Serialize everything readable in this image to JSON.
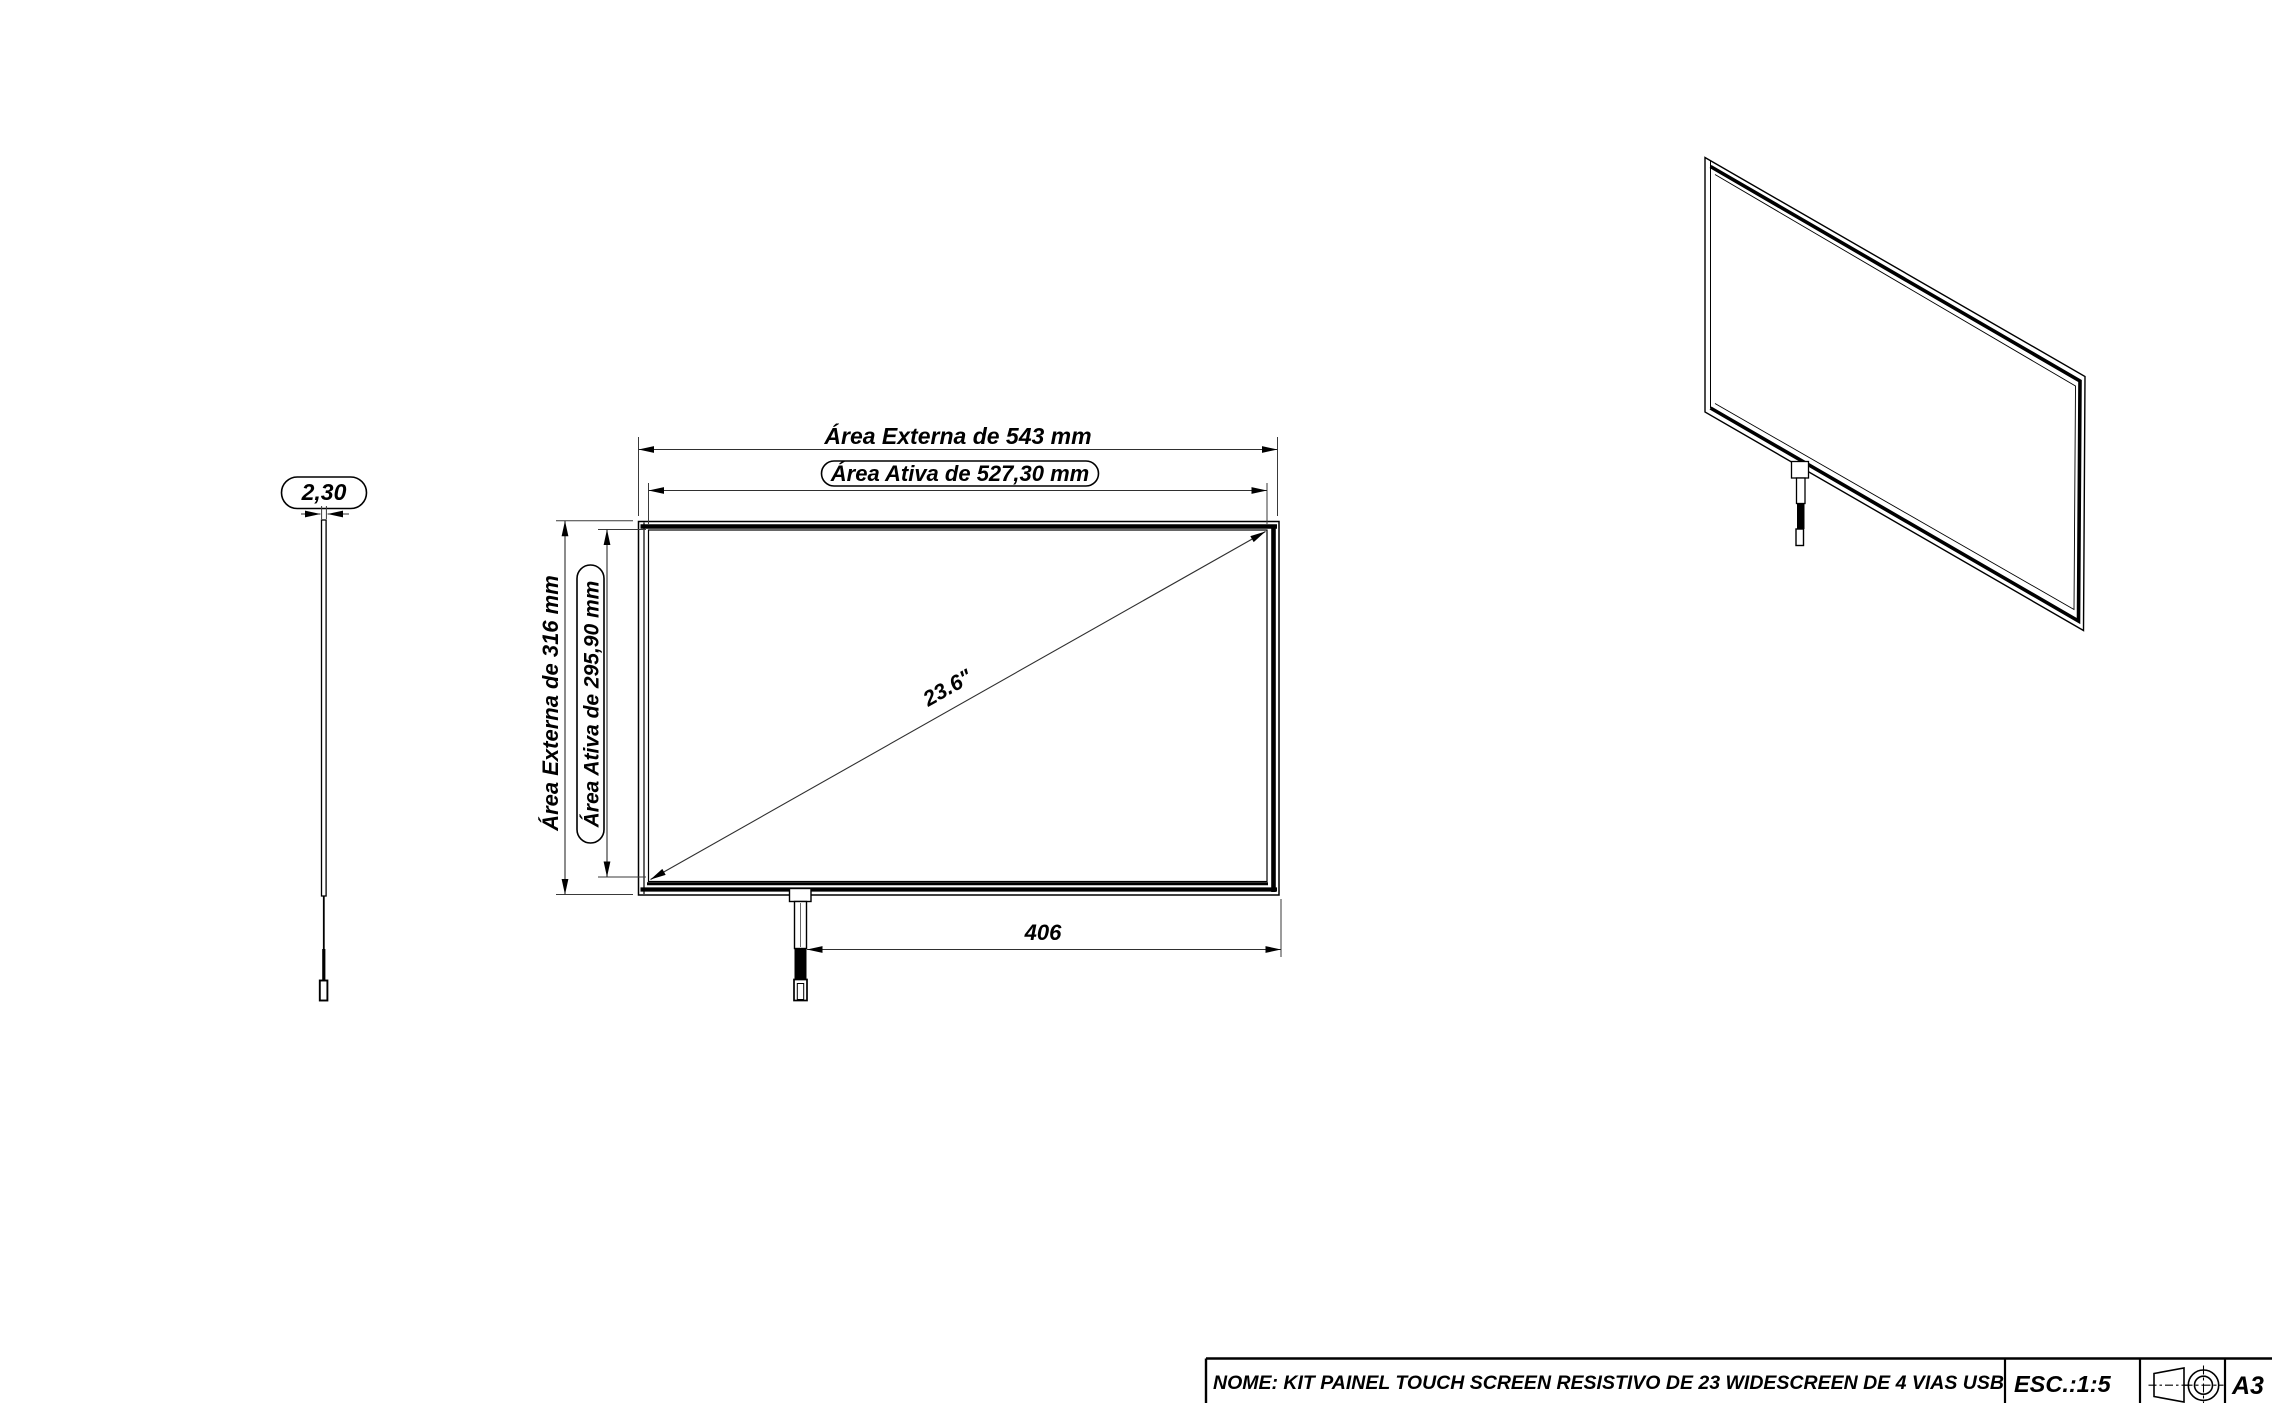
{
  "drawing": {
    "side_view": {
      "thickness_label": "2,30"
    },
    "front_view": {
      "outer_width_label": "Área Externa de 543 mm",
      "active_width_label": "Área Ativa de 527,30 mm",
      "outer_height_label": "Área Externa de 316 mm",
      "active_height_label": "Área Ativa de 295,90 mm",
      "diagonal_label": "23.6\"",
      "cable_offset_label": "406"
    }
  },
  "title_block": {
    "name_label": "NOME: KIT PAINEL TOUCH SCREEN RESISTIVO DE 23 WIDESCREEN DE 4 VIAS USB",
    "scale_label": "ESC.:1:5",
    "sheet_size_label": "A3",
    "projection_symbol": "first-angle-projection-icon"
  },
  "colors": {
    "background": "#ffffff",
    "object_line": "#000000",
    "dimension_line": "#2f2f2f"
  }
}
